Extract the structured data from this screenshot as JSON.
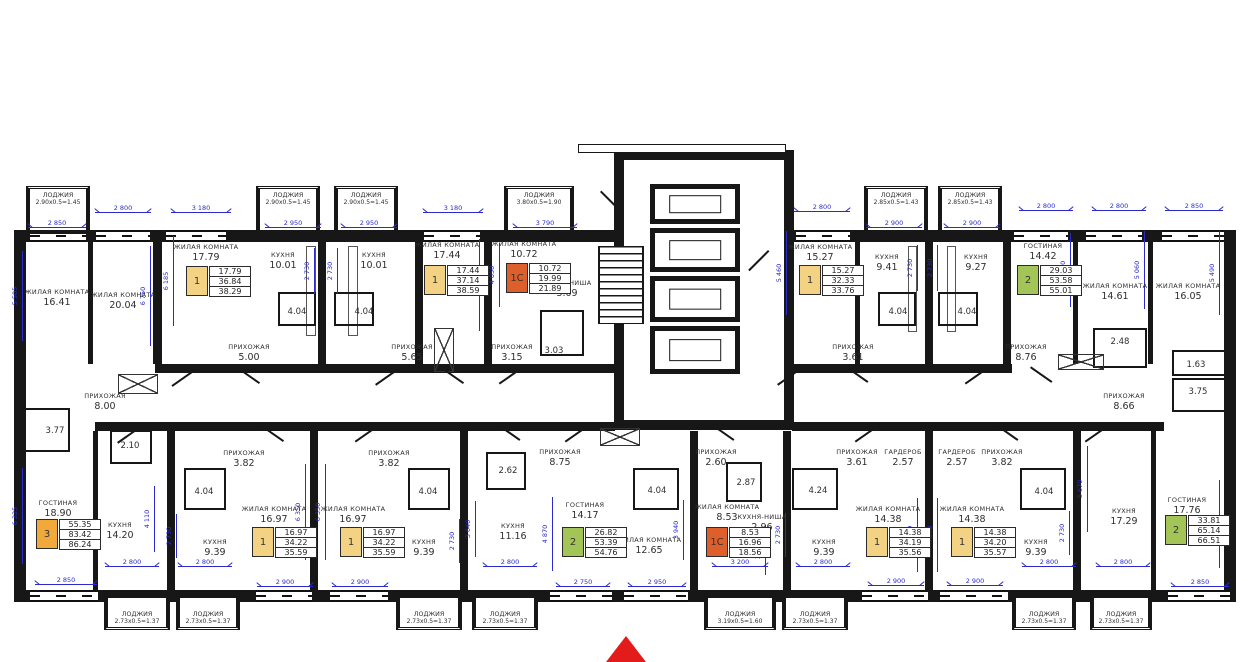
{
  "plan": {
    "colors": {
      "wall": "#171717",
      "dim": "#2a2ace",
      "badge_yellow": "#F3D283",
      "badge_orange": "#DD5F2B",
      "badge_green": "#A3C457",
      "badge_amber": "#F2A93B",
      "entrance": "#E31B1B"
    },
    "rooms": [
      {
        "n": "ЖИЛАЯ КОМНАТА",
        "a": "16.41",
        "x": 57,
        "y": 298
      },
      {
        "n": "ЖИЛАЯ КОМНАТА",
        "a": "20.04",
        "x": 123,
        "y": 301
      },
      {
        "n": "ЖИЛАЯ КОМНАТА",
        "a": "17.79",
        "x": 206,
        "y": 253
      },
      {
        "n": "КУХНЯ",
        "a": "10.01",
        "x": 283,
        "y": 261
      },
      {
        "n": "КУХНЯ",
        "a": "10.01",
        "x": 374,
        "y": 261
      },
      {
        "n": "ЖИЛАЯ КОМНАТА",
        "a": "17.44",
        "x": 447,
        "y": 251
      },
      {
        "n": "ЖИЛАЯ КОМНАТА",
        "a": "10.72",
        "x": 524,
        "y": 250
      },
      {
        "n": "КУХНЯ-НИША",
        "a": "3.09",
        "x": 567,
        "y": 289
      },
      {
        "n": "ПРИХОЖАЯ",
        "a": "8.00",
        "x": 105,
        "y": 402
      },
      {
        "n": "ПРИХОЖАЯ",
        "a": "5.00",
        "x": 249,
        "y": 353
      },
      {
        "n": "ПРИХОЖАЯ",
        "a": "5.65",
        "x": 412,
        "y": 353
      },
      {
        "n": "ПРИХОЖАЯ",
        "a": "3.15",
        "x": 512,
        "y": 353
      },
      {
        "n": "",
        "a": "3.03",
        "x": 554,
        "y": 351
      },
      {
        "n": "",
        "a": "4.04",
        "x": 297,
        "y": 312
      },
      {
        "n": "",
        "a": "4.04",
        "x": 364,
        "y": 312
      },
      {
        "n": "ЖИЛАЯ КОМНАТА",
        "a": "15.27",
        "x": 820,
        "y": 253
      },
      {
        "n": "КУХНЯ",
        "a": "9.41",
        "x": 887,
        "y": 263
      },
      {
        "n": "КУХНЯ",
        "a": "9.27",
        "x": 976,
        "y": 263
      },
      {
        "n": "",
        "a": "4.04",
        "x": 898,
        "y": 312
      },
      {
        "n": "",
        "a": "4.04",
        "x": 967,
        "y": 312
      },
      {
        "n": "ПРИХОЖАЯ",
        "a": "3.61",
        "x": 853,
        "y": 353
      },
      {
        "n": "ГОСТИНАЯ",
        "a": "14.42",
        "x": 1043,
        "y": 252
      },
      {
        "n": "ЖИЛАЯ КОМНАТА",
        "a": "14.61",
        "x": 1115,
        "y": 292
      },
      {
        "n": "ЖИЛАЯ КОМНАТА",
        "a": "16.05",
        "x": 1188,
        "y": 292
      },
      {
        "n": "ПРИХОЖАЯ",
        "a": "8.76",
        "x": 1026,
        "y": 353
      },
      {
        "n": "",
        "a": "2.48",
        "x": 1120,
        "y": 342
      },
      {
        "n": "",
        "a": "1.63",
        "x": 1196,
        "y": 365
      },
      {
        "n": "",
        "a": "3.75",
        "x": 1198,
        "y": 392
      },
      {
        "n": "ПРИХОЖАЯ",
        "a": "8.66",
        "x": 1124,
        "y": 402
      },
      {
        "n": "",
        "a": "3.77",
        "x": 55,
        "y": 431
      },
      {
        "n": "",
        "a": "2.10",
        "x": 130,
        "y": 446
      },
      {
        "n": "ГОСТИНАЯ",
        "a": "18.90",
        "x": 58,
        "y": 509
      },
      {
        "n": "КУХНЯ",
        "a": "14.20",
        "x": 120,
        "y": 531
      },
      {
        "n": "",
        "a": "4.04",
        "x": 204,
        "y": 492
      },
      {
        "n": "КУХНЯ",
        "a": "9.39",
        "x": 215,
        "y": 548
      },
      {
        "n": "ПРИХОЖАЯ",
        "a": "3.82",
        "x": 244,
        "y": 459
      },
      {
        "n": "ПРИХОЖАЯ",
        "a": "3.82",
        "x": 389,
        "y": 459
      },
      {
        "n": "ЖИЛАЯ КОМНАТА",
        "a": "16.97",
        "x": 274,
        "y": 515
      },
      {
        "n": "ЖИЛАЯ КОМНАТА",
        "a": "16.97",
        "x": 353,
        "y": 515
      },
      {
        "n": "",
        "a": "4.04",
        "x": 428,
        "y": 492
      },
      {
        "n": "КУХНЯ",
        "a": "9.39",
        "x": 424,
        "y": 548
      },
      {
        "n": "",
        "a": "2.62",
        "x": 508,
        "y": 471
      },
      {
        "n": "ПРИХОЖАЯ",
        "a": "8.75",
        "x": 560,
        "y": 458
      },
      {
        "n": "КУХНЯ",
        "a": "11.16",
        "x": 513,
        "y": 532
      },
      {
        "n": "ГОСТИНАЯ",
        "a": "14.17",
        "x": 585,
        "y": 511
      },
      {
        "n": "ЖИЛАЯ КОМНАТА",
        "a": "12.65",
        "x": 649,
        "y": 546
      },
      {
        "n": "",
        "a": "4.04",
        "x": 657,
        "y": 491
      },
      {
        "n": "ПРИХОЖАЯ",
        "a": "2.60",
        "x": 716,
        "y": 458
      },
      {
        "n": "",
        "a": "2.87",
        "x": 746,
        "y": 483
      },
      {
        "n": "ЖИЛАЯ КОМНАТА",
        "a": "8.53",
        "x": 727,
        "y": 513
      },
      {
        "n": "КУХНЯ-НИША",
        "a": "2.96",
        "x": 762,
        "y": 523
      },
      {
        "n": "",
        "a": "4.24",
        "x": 818,
        "y": 491
      },
      {
        "n": "КУХНЯ",
        "a": "9.39",
        "x": 824,
        "y": 548
      },
      {
        "n": "ПРИХОЖАЯ",
        "a": "3.61",
        "x": 857,
        "y": 458
      },
      {
        "n": "ГАРДЕРОБ",
        "a": "2.57",
        "x": 903,
        "y": 458
      },
      {
        "n": "ГАРДЕРОБ",
        "a": "2.57",
        "x": 957,
        "y": 458
      },
      {
        "n": "ПРИХОЖАЯ",
        "a": "3.82",
        "x": 1002,
        "y": 458
      },
      {
        "n": "ЖИЛАЯ КОМНАТА",
        "a": "14.38",
        "x": 888,
        "y": 515
      },
      {
        "n": "ЖИЛАЯ КОМНАТА",
        "a": "14.38",
        "x": 972,
        "y": 515
      },
      {
        "n": "",
        "a": "4.04",
        "x": 1044,
        "y": 492
      },
      {
        "n": "КУХНЯ",
        "a": "9.39",
        "x": 1036,
        "y": 548
      },
      {
        "n": "КУХНЯ",
        "a": "17.29",
        "x": 1124,
        "y": 517
      },
      {
        "n": "ГОСТИНАЯ",
        "a": "17.76",
        "x": 1187,
        "y": 506
      }
    ],
    "loggias": [
      {
        "n": "ЛОДЖИЯ",
        "s": "2.90x0.5=1.45",
        "x": 26,
        "y": 186,
        "w": 64,
        "h": 48,
        "side": "top"
      },
      {
        "n": "ЛОДЖИЯ",
        "s": "2.90x0.5=1.45",
        "x": 256,
        "y": 186,
        "w": 64,
        "h": 48,
        "side": "top"
      },
      {
        "n": "ЛОДЖИЯ",
        "s": "2.90x0.5=1.45",
        "x": 334,
        "y": 186,
        "w": 64,
        "h": 48,
        "side": "top"
      },
      {
        "n": "ЛОДЖИЯ",
        "s": "3.80x0.5=1.90",
        "x": 504,
        "y": 186,
        "w": 70,
        "h": 48,
        "side": "top"
      },
      {
        "n": "ЛОДЖИЯ",
        "s": "2.85x0.5=1.43",
        "x": 864,
        "y": 186,
        "w": 64,
        "h": 48,
        "side": "top"
      },
      {
        "n": "ЛОДЖИЯ",
        "s": "2.85x0.5=1.43",
        "x": 938,
        "y": 186,
        "w": 64,
        "h": 48,
        "side": "top"
      },
      {
        "n": "ЛОДЖИЯ",
        "s": "2.73x0.5=1.37",
        "x": 104,
        "y": 594,
        "w": 66,
        "h": 36,
        "side": "bot"
      },
      {
        "n": "ЛОДЖИЯ",
        "s": "2.73x0.5=1.37",
        "x": 176,
        "y": 594,
        "w": 64,
        "h": 36,
        "side": "bot"
      },
      {
        "n": "ЛОДЖИЯ",
        "s": "2.73x0.5=1.37",
        "x": 396,
        "y": 594,
        "w": 66,
        "h": 36,
        "side": "bot"
      },
      {
        "n": "ЛОДЖИЯ",
        "s": "2.73x0.5=1.37",
        "x": 472,
        "y": 594,
        "w": 66,
        "h": 36,
        "side": "bot"
      },
      {
        "n": "ЛОДЖИЯ",
        "s": "3.19x0.5=1.60",
        "x": 704,
        "y": 594,
        "w": 72,
        "h": 36,
        "side": "bot"
      },
      {
        "n": "ЛОДЖИЯ",
        "s": "2.73x0.5=1.37",
        "x": 782,
        "y": 594,
        "w": 66,
        "h": 36,
        "side": "bot"
      },
      {
        "n": "ЛОДЖИЯ",
        "s": "2.73x0.5=1.37",
        "x": 1012,
        "y": 594,
        "w": 64,
        "h": 36,
        "side": "bot"
      },
      {
        "n": "ЛОДЖИЯ",
        "s": "2.73x0.5=1.37",
        "x": 1090,
        "y": 594,
        "w": 62,
        "h": 36,
        "side": "bot"
      }
    ],
    "badges": [
      {
        "num": "1",
        "c": "badge_yellow",
        "v": [
          "17.79",
          "36.84",
          "38.29"
        ],
        "x": 186,
        "y": 266
      },
      {
        "num": "1",
        "c": "badge_yellow",
        "v": [
          "17.44",
          "37.14",
          "38.59"
        ],
        "x": 424,
        "y": 265
      },
      {
        "num": "1С",
        "c": "badge_orange",
        "v": [
          "10.72",
          "19.99",
          "21.89"
        ],
        "x": 506,
        "y": 263
      },
      {
        "num": "1",
        "c": "badge_yellow",
        "v": [
          "15.27",
          "32.33",
          "33.76"
        ],
        "x": 799,
        "y": 265
      },
      {
        "num": "2",
        "c": "badge_green",
        "v": [
          "29.03",
          "53.58",
          "55.01"
        ],
        "x": 1017,
        "y": 265
      },
      {
        "num": "3",
        "c": "badge_amber",
        "v": [
          "55.35",
          "83.42",
          "86.24"
        ],
        "x": 36,
        "y": 519
      },
      {
        "num": "1",
        "c": "badge_yellow",
        "v": [
          "16.97",
          "34.22",
          "35.59"
        ],
        "x": 252,
        "y": 527
      },
      {
        "num": "1",
        "c": "badge_yellow",
        "v": [
          "16.97",
          "34.22",
          "35.59"
        ],
        "x": 340,
        "y": 527
      },
      {
        "num": "2",
        "c": "badge_green",
        "v": [
          "26.82",
          "53.39",
          "54.76"
        ],
        "x": 562,
        "y": 527
      },
      {
        "num": "1С",
        "c": "badge_orange",
        "v": [
          "8.53",
          "16.96",
          "18.56"
        ],
        "x": 706,
        "y": 527
      },
      {
        "num": "1",
        "c": "badge_yellow",
        "v": [
          "14.38",
          "34.19",
          "35.56"
        ],
        "x": 866,
        "y": 527
      },
      {
        "num": "1",
        "c": "badge_yellow",
        "v": [
          "14.38",
          "34.20",
          "35.57"
        ],
        "x": 951,
        "y": 527
      },
      {
        "num": "2",
        "c": "badge_green",
        "v": [
          "33.81",
          "65.14",
          "66.51"
        ],
        "x": 1165,
        "y": 515
      }
    ],
    "dims_h": [
      {
        "t": "2 850",
        "x": 57,
        "y": 227,
        "w": 58
      },
      {
        "t": "2 800",
        "x": 123,
        "y": 212,
        "w": 56
      },
      {
        "t": "3 180",
        "x": 201,
        "y": 212,
        "w": 60
      },
      {
        "t": "2 950",
        "x": 293,
        "y": 227,
        "w": 56
      },
      {
        "t": "2 950",
        "x": 369,
        "y": 227,
        "w": 56
      },
      {
        "t": "3 180",
        "x": 453,
        "y": 212,
        "w": 60
      },
      {
        "t": "3 790",
        "x": 545,
        "y": 227,
        "w": 64
      },
      {
        "t": "2 800",
        "x": 822,
        "y": 211,
        "w": 56
      },
      {
        "t": "2 900",
        "x": 894,
        "y": 227,
        "w": 56
      },
      {
        "t": "2 900",
        "x": 972,
        "y": 227,
        "w": 56
      },
      {
        "t": "2 800",
        "x": 1046,
        "y": 210,
        "w": 54
      },
      {
        "t": "2 800",
        "x": 1119,
        "y": 210,
        "w": 54
      },
      {
        "t": "2 850",
        "x": 1194,
        "y": 210,
        "w": 58
      },
      {
        "t": "2 850",
        "x": 66,
        "y": 584,
        "w": 62
      },
      {
        "t": "2 800",
        "x": 132,
        "y": 566,
        "w": 54
      },
      {
        "t": "2 800",
        "x": 205,
        "y": 566,
        "w": 54
      },
      {
        "t": "2 900",
        "x": 285,
        "y": 586,
        "w": 56
      },
      {
        "t": "2 900",
        "x": 360,
        "y": 586,
        "w": 56
      },
      {
        "t": "2 800",
        "x": 510,
        "y": 566,
        "w": 54
      },
      {
        "t": "2 750",
        "x": 583,
        "y": 586,
        "w": 54
      },
      {
        "t": "2 950",
        "x": 657,
        "y": 586,
        "w": 58
      },
      {
        "t": "3 200",
        "x": 740,
        "y": 566,
        "w": 56
      },
      {
        "t": "2 800",
        "x": 823,
        "y": 566,
        "w": 54
      },
      {
        "t": "2 900",
        "x": 896,
        "y": 585,
        "w": 56
      },
      {
        "t": "2 900",
        "x": 975,
        "y": 585,
        "w": 56
      },
      {
        "t": "2 800",
        "x": 1049,
        "y": 566,
        "w": 54
      },
      {
        "t": "2 800",
        "x": 1123,
        "y": 566,
        "w": 54
      },
      {
        "t": "2 850",
        "x": 1200,
        "y": 586,
        "w": 58
      }
    ],
    "dims_v": [
      {
        "t": "5 505",
        "x": 22,
        "y": 296,
        "h": 90
      },
      {
        "t": "6 750",
        "x": 150,
        "y": 296,
        "h": 100
      },
      {
        "t": "6 185",
        "x": 173,
        "y": 281,
        "h": 90
      },
      {
        "t": "2 730",
        "x": 314,
        "y": 271,
        "h": 46
      },
      {
        "t": "2 730",
        "x": 337,
        "y": 271,
        "h": 46
      },
      {
        "t": "6 250",
        "x": 479,
        "y": 285,
        "h": 92
      },
      {
        "t": "4 050",
        "x": 499,
        "y": 275,
        "h": 64
      },
      {
        "t": "5 460",
        "x": 786,
        "y": 273,
        "h": 84
      },
      {
        "t": "2 730",
        "x": 917,
        "y": 268,
        "h": 46
      },
      {
        "t": "2 730",
        "x": 937,
        "y": 268,
        "h": 46
      },
      {
        "t": "4 870",
        "x": 1070,
        "y": 270,
        "h": 74
      },
      {
        "t": "5 060",
        "x": 1144,
        "y": 270,
        "h": 78
      },
      {
        "t": "5 490",
        "x": 1219,
        "y": 273,
        "h": 84
      },
      {
        "t": "6 325",
        "x": 22,
        "y": 516,
        "h": 96
      },
      {
        "t": "4 110",
        "x": 154,
        "y": 519,
        "h": 66
      },
      {
        "t": "2 730",
        "x": 176,
        "y": 536,
        "h": 44
      },
      {
        "t": "6 350",
        "x": 305,
        "y": 512,
        "h": 96
      },
      {
        "t": "6 350",
        "x": 325,
        "y": 512,
        "h": 96
      },
      {
        "t": "2 730",
        "x": 459,
        "y": 541,
        "h": 44
      },
      {
        "t": "3 640",
        "x": 475,
        "y": 529,
        "h": 56
      },
      {
        "t": "4 870",
        "x": 552,
        "y": 534,
        "h": 74
      },
      {
        "t": "3 940",
        "x": 683,
        "y": 530,
        "h": 60
      },
      {
        "t": "3 120",
        "x": 765,
        "y": 550,
        "h": 50
      },
      {
        "t": "2 730",
        "x": 785,
        "y": 535,
        "h": 44
      },
      {
        "t": "4 870",
        "x": 917,
        "y": 535,
        "h": 74
      },
      {
        "t": "4 870",
        "x": 937,
        "y": 535,
        "h": 74
      },
      {
        "t": "2 730",
        "x": 1069,
        "y": 533,
        "h": 44
      },
      {
        "t": "5 670",
        "x": 1087,
        "y": 489,
        "h": 86
      },
      {
        "t": "5 725",
        "x": 1219,
        "y": 524,
        "h": 88
      }
    ]
  }
}
